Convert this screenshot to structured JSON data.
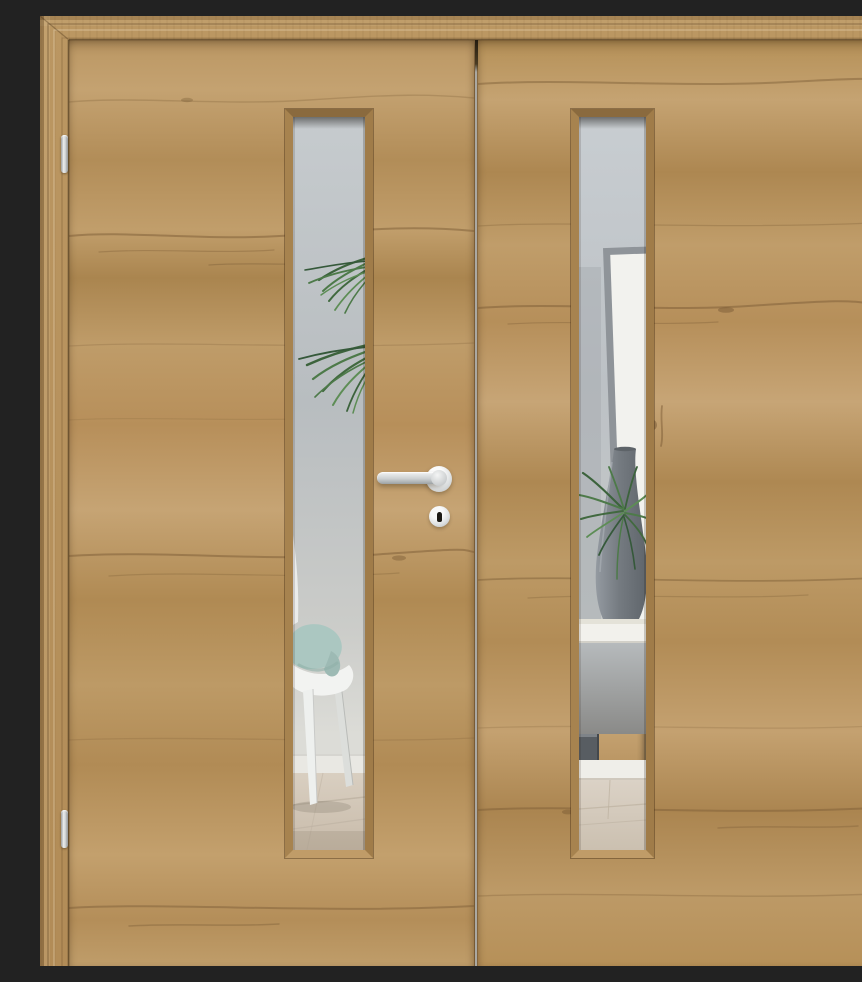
{
  "meta": {
    "title": "Closed double interior door in light oak with vertical frosted glazing strips, seen straight on",
    "view": "front"
  },
  "colors": {
    "frame_wood": "#b8935f",
    "wood_light": "#c7a576",
    "wood_mid": "#b6915e",
    "wood_dark": "#9d7a4b",
    "wood_grain": "#7b5c36",
    "gap_line": "#aaa8a2",
    "glass_wall_top": "#c6cbce",
    "glass_wall_mid": "#b8bdc0",
    "baseboard_white": "#e9e8e3",
    "floor_wood": "#d8cec0",
    "cushion_teal": "#abc7c1",
    "chair_white": "#f2f3f1",
    "plant_green": "#4d7a49",
    "plant_green_dark": "#3c633c",
    "plant_green_light": "#5d8d55",
    "vase_gray": "#757b81",
    "picture_frame_gray": "#8f9499",
    "picture_frame_mat": "#f2f2ee",
    "shelf_white": "#f2f1ec",
    "shelf_interior_gray": "#9c9e9d",
    "books_gray": "#585d62",
    "metal_steel": "#d6d8d9"
  },
  "door": {
    "leaves": [
      {
        "id": "left",
        "glazing": "vertical frosted lite",
        "hardware": [
          "lever handle",
          "keyhole escutcheon"
        ],
        "hinges": 2
      },
      {
        "id": "right",
        "glazing": "vertical frosted lite",
        "hardware": [],
        "hinges": 2
      }
    ],
    "scene_behind_glass": {
      "left": "white chair with pale teal cushion, overhanging palm fronds, white baseboard, light wood floor",
      "right": "leaning grey picture frame, tall grey floor vase with green palm, white sideboard with dark books, light wood floor"
    }
  }
}
